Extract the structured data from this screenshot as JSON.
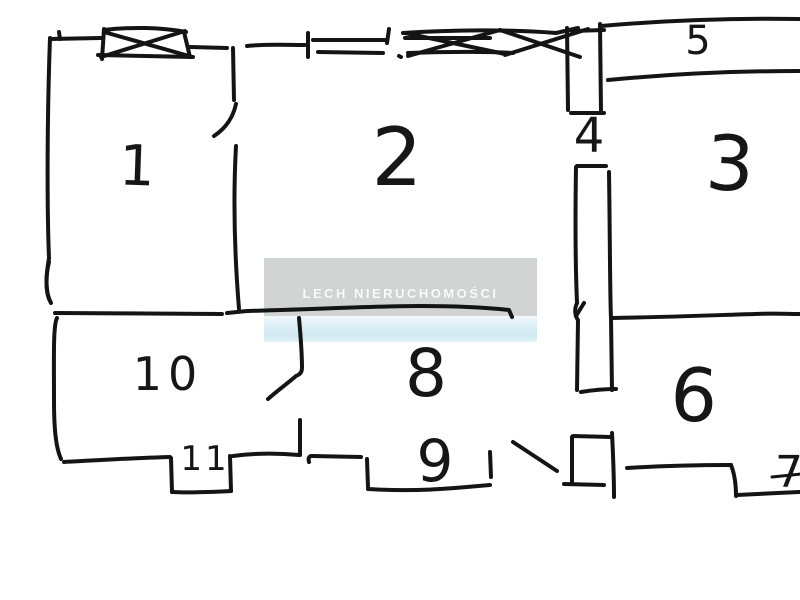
{
  "document": {
    "kind": "hand-drawn apartment floor plan sketch",
    "background": "#ffffff",
    "ink_color": "#141414"
  },
  "watermark": {
    "text": "LECH NIERUCHOMOŚCI",
    "bg_color": "#d2d3d3",
    "text_color": "#fbfcfc",
    "band_color": "#cfe8f1"
  },
  "rooms": [
    {
      "id": "room-1",
      "label": "1"
    },
    {
      "id": "room-2",
      "label": "2"
    },
    {
      "id": "room-3",
      "label": "3"
    },
    {
      "id": "room-4",
      "label": "4"
    },
    {
      "id": "room-5",
      "label": "5"
    },
    {
      "id": "room-6",
      "label": "6"
    },
    {
      "id": "room-7",
      "label": "7"
    },
    {
      "id": "room-8",
      "label": "8"
    },
    {
      "id": "room-9",
      "label": "9"
    },
    {
      "id": "room-10",
      "label": "10"
    },
    {
      "id": "room-11",
      "label": "11"
    }
  ],
  "symbols": [
    {
      "name": "crossed-window",
      "count": 2
    },
    {
      "name": "double-line-window",
      "count": 1
    },
    {
      "name": "door-swing",
      "count": 3
    }
  ]
}
